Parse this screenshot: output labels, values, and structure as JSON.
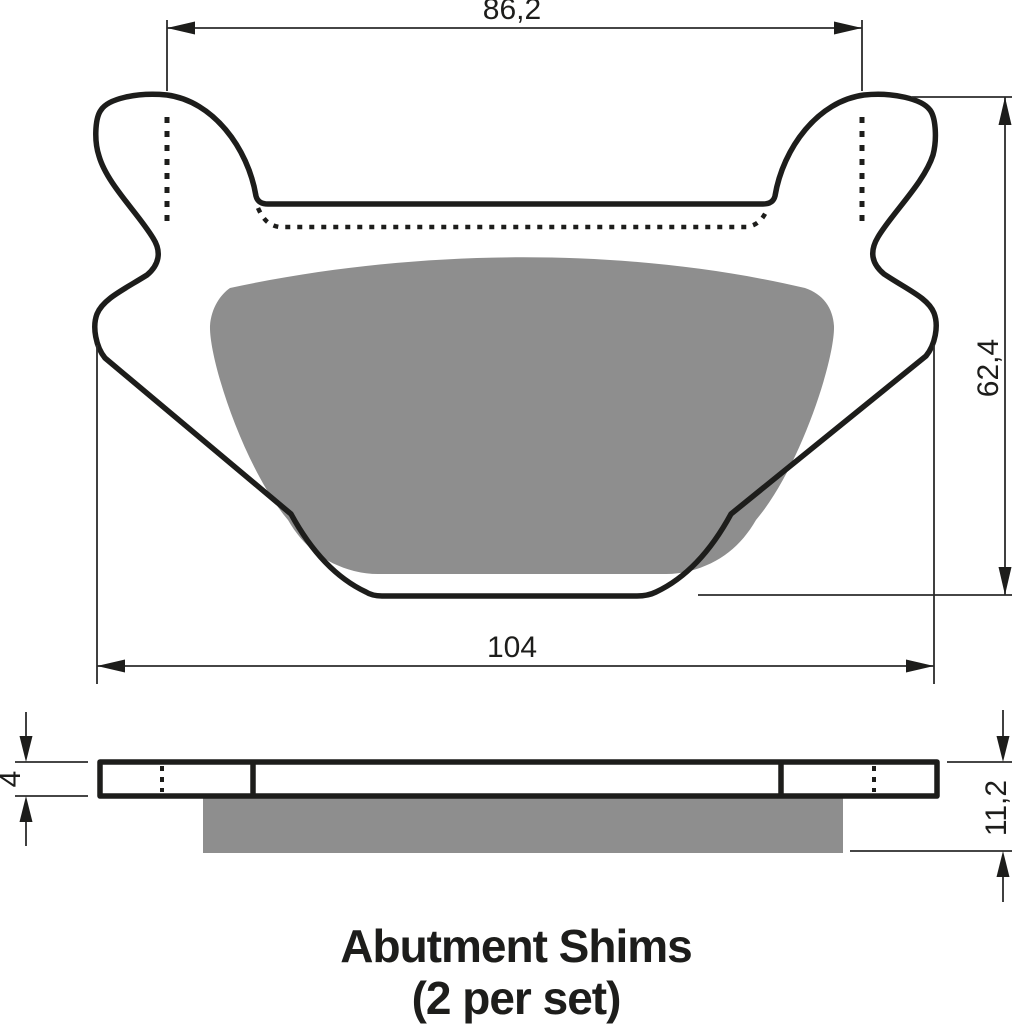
{
  "caption": {
    "line1": "Abutment Shims",
    "line2": "(2 per set)"
  },
  "dimensions": {
    "upper_width": "86,2",
    "overall_width": "104",
    "height": "62,4",
    "backplate_thickness": "4",
    "total_thickness": "11,2"
  },
  "colors": {
    "line_black": "#1d1d1b",
    "dim_line": "#2b2b2b",
    "friction_gray": "#8e8e8e",
    "background": "#ffffff"
  }
}
